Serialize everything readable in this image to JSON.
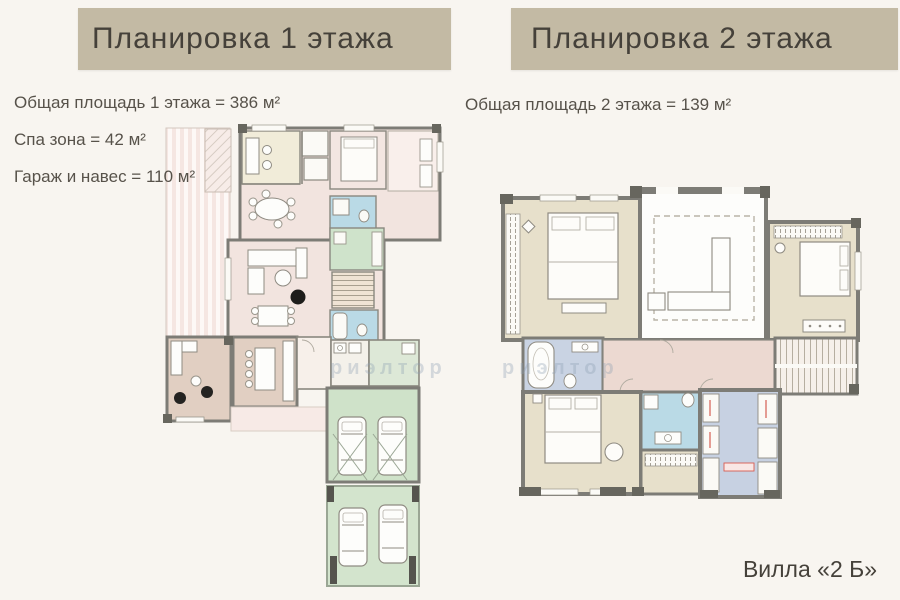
{
  "page": {
    "background_color": "#f8f5f0",
    "watermark_text": "риэлтор",
    "footer_label": "Вилла «2 Б»"
  },
  "banners": {
    "color": "#c3baa4",
    "text_color": "#45413a"
  },
  "floor1": {
    "title": "Планировка 1 этажа",
    "stats": [
      "Общая площадь 1 этажа = 386 м²",
      "Спа зона = 42 м²",
      "Гараж и навес = 110 м²"
    ]
  },
  "floor2": {
    "title": "Планировка 2 этажа",
    "stats": [
      "Общая площадь 2 этажа = 139 м²"
    ]
  },
  "plan_colors": {
    "wall": "#7d7c76",
    "pillar": "#67665e",
    "floor_pink": "#f2e4df",
    "floor_cream": "#f1ecd9",
    "floor_beige": "#e7e0cb",
    "floor_tan": "#e1cfc2",
    "floor_blue": "#badae6",
    "floor_green": "#cfe2c9",
    "floor_lavender": "#c7d1e2",
    "corridor_tan": "#ecd9d1",
    "terrace_pale": "#f7ece8",
    "accent_red": "#d65c52"
  }
}
